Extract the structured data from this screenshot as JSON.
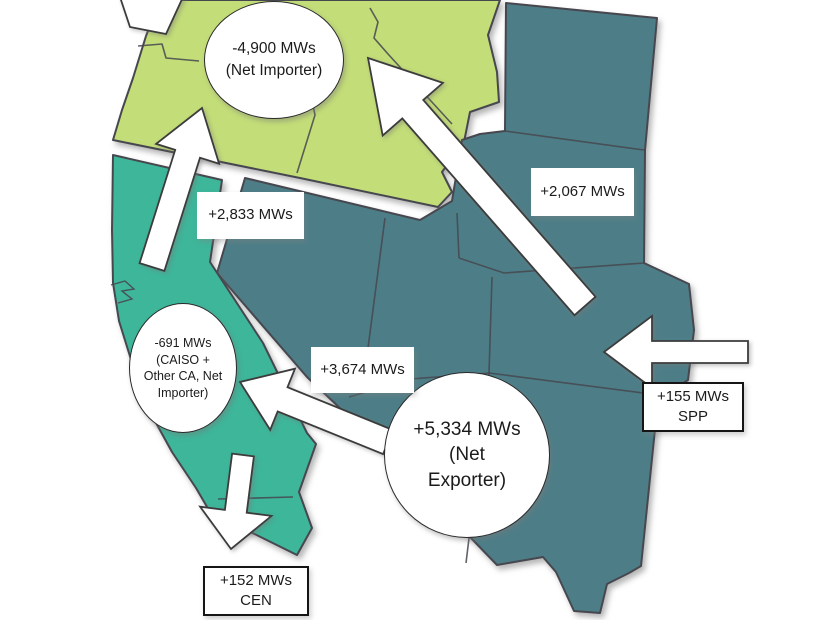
{
  "map": {
    "background_color": "#ffffff",
    "region_border_color": "#47474f",
    "arrow_color": "#ffffff",
    "arrow_outline_color": "#3c3c3c",
    "regions": {
      "northwest": {
        "color": "#c3dd78",
        "badge_lines": [
          "-4,900 MWs",
          "(Net Importer)"
        ]
      },
      "california": {
        "color": "#3db69a",
        "badge_lines": [
          "-691 MWs",
          "(CAISO +",
          "Other CA, Net",
          "Importer)"
        ]
      },
      "interior_west": {
        "color": "#4d7e88",
        "badge_lines": [
          "+5,334 MWs",
          "(Net",
          "Exporter)"
        ]
      }
    },
    "flows": {
      "interior_to_northwest": {
        "label": "+2,067 MWs"
      },
      "california_to_northwest": {
        "label": "+2,833 MWs"
      },
      "interior_to_california": {
        "label": "+3,674 MWs"
      },
      "spp_to_interior": {
        "lines": [
          "+155 MWs",
          "SPP"
        ]
      },
      "california_to_cen": {
        "lines": [
          "+152 MWs",
          "CEN"
        ]
      }
    }
  }
}
